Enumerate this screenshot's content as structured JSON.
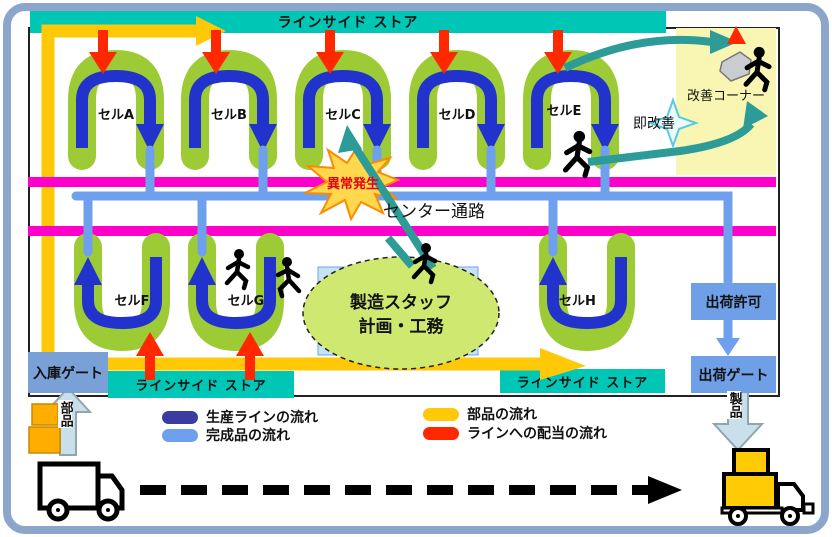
{
  "colors": {
    "frame": "#8CA6CB",
    "teal_bar": "#00C7B5",
    "cell_green": "#9CCB35",
    "cell_blue": "#2133CC",
    "flow_lightblue": "#6FA0EE",
    "flow_yellow": "#FFC908",
    "flow_red": "#FF2800",
    "magenta_rail": "#FF00CC",
    "kaizen_teal": "#2D9B97",
    "panel_yellow": "#F8F6B2",
    "gate_blue": "#6F9FE6"
  },
  "top_bar": {
    "label": "ラインサイド ストア"
  },
  "cells_top": [
    {
      "label": "セルA"
    },
    {
      "label": "セルB"
    },
    {
      "label": "セルC"
    },
    {
      "label": "セルD"
    },
    {
      "label": "セルE"
    }
  ],
  "cells_bottom": [
    {
      "label": "セルF"
    },
    {
      "label": "セルG"
    },
    {
      "label": "セルH"
    }
  ],
  "center_aisle": {
    "label": "センター通路"
  },
  "abnormal": {
    "label": "異常発生"
  },
  "kaizen": {
    "corner_label": "改善コーナー",
    "immediate_label": "即改善"
  },
  "staff": {
    "line1": "製造スタッフ",
    "line2": "計画・工務"
  },
  "shipping": {
    "permit": "出荷許可",
    "gate": "出荷ゲート",
    "product": "製品"
  },
  "inbound": {
    "gate": "入庫ゲート",
    "parts": "部品"
  },
  "stores": {
    "bottom_left": "ラインサイド ストア",
    "bottom_right": "ラインサイド ストア"
  },
  "legend": {
    "items": [
      {
        "label": "生産ラインの流れ",
        "color": "#3A3CA0"
      },
      {
        "label": "完成品の流れ",
        "color": "#6FA0EE"
      },
      {
        "label": "部品の流れ",
        "color": "#FFC908"
      },
      {
        "label": "ラインへの配当の流れ",
        "color": "#FF2800"
      }
    ]
  }
}
